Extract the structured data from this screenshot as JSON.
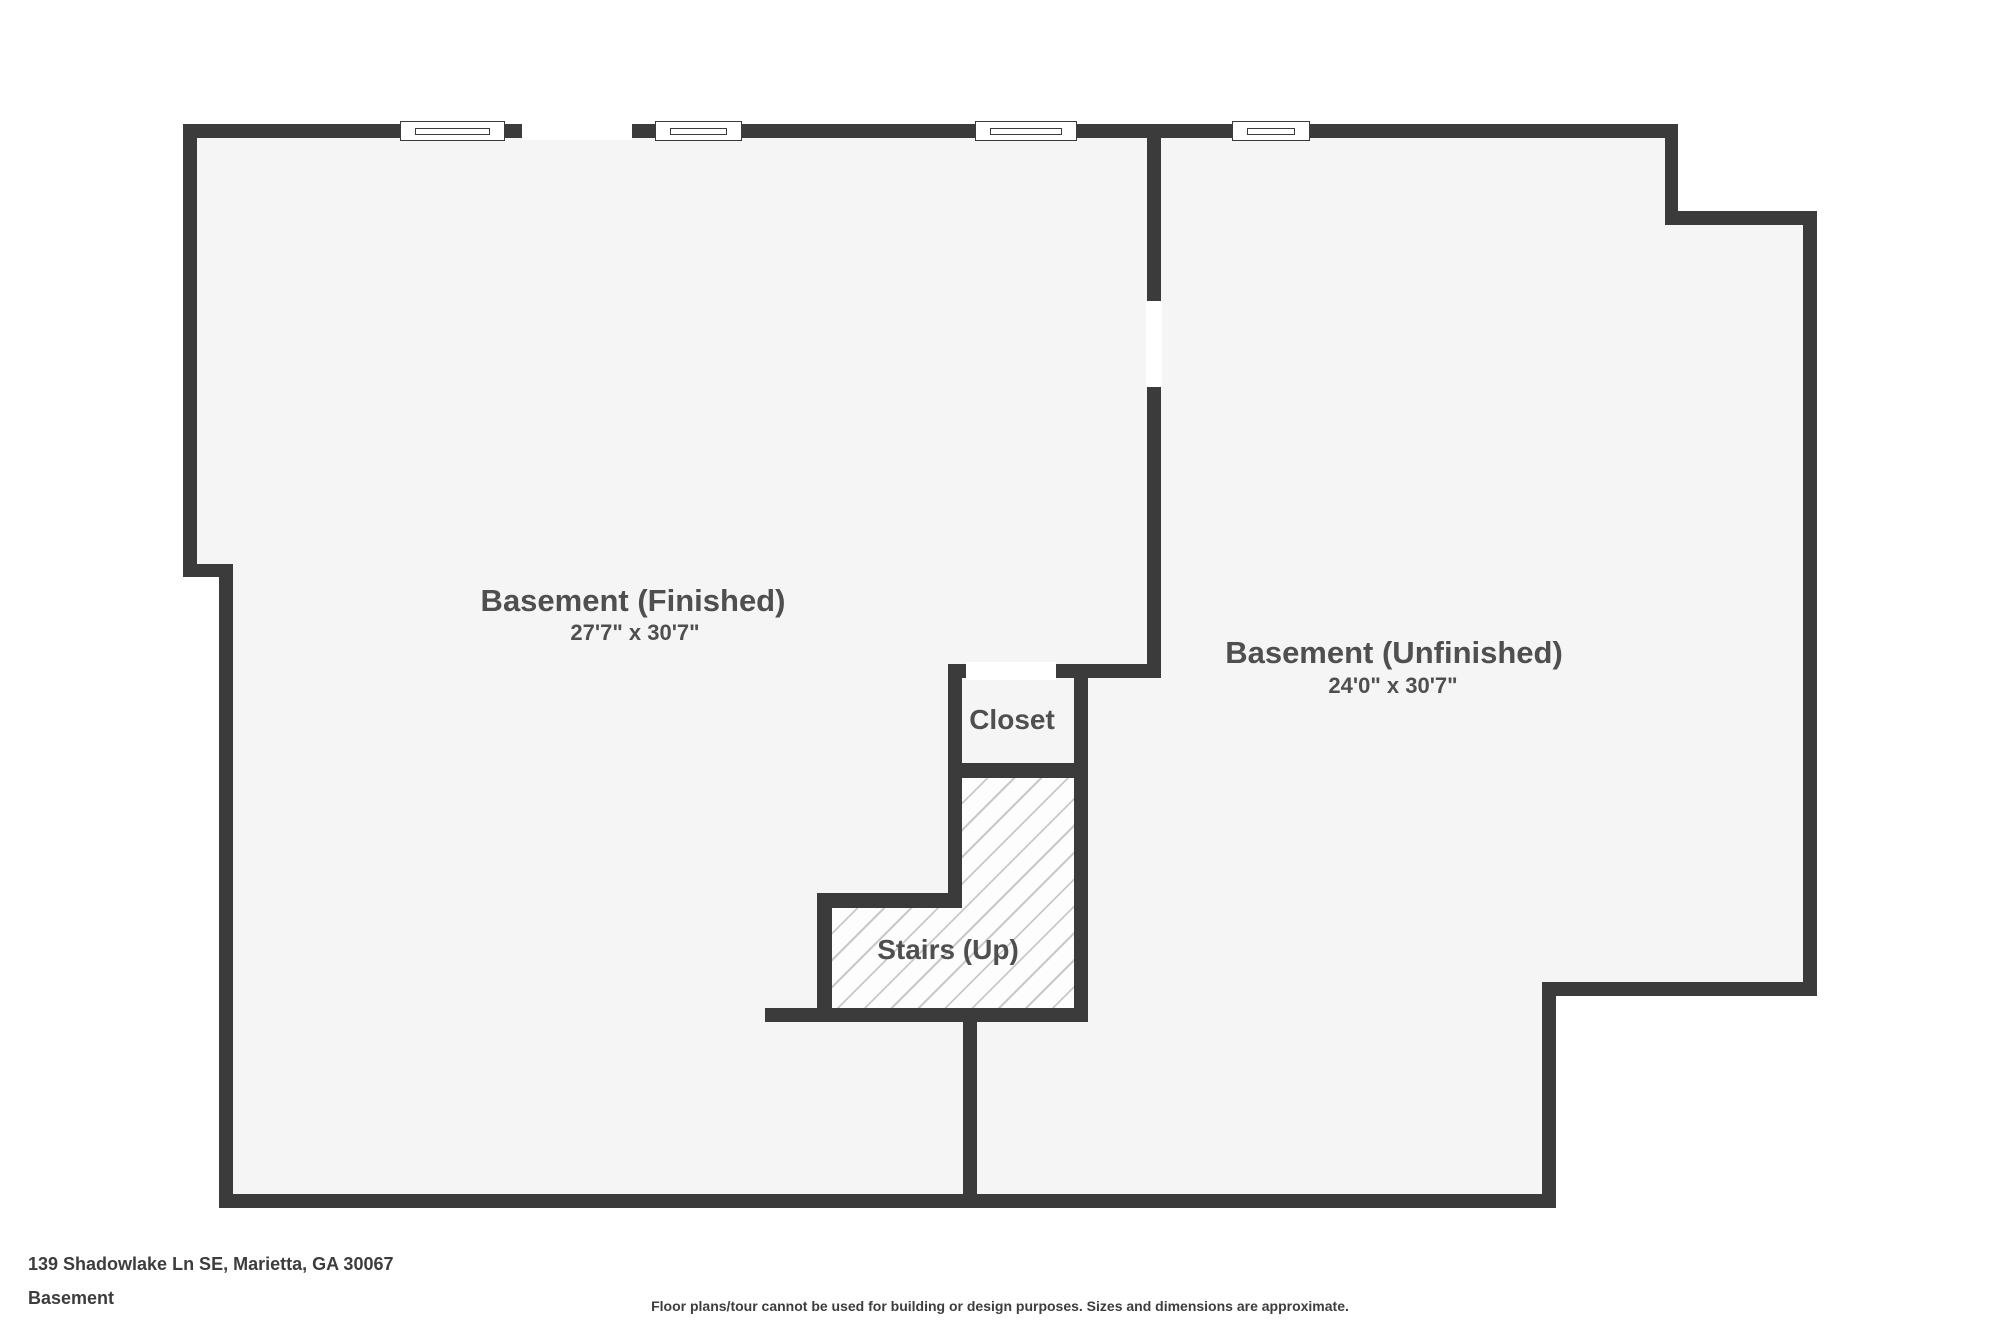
{
  "rooms": {
    "finished": {
      "name": "Basement (Finished)",
      "dims": "27'7\" x 30'7\""
    },
    "unfinished": {
      "name": "Basement (Unfinished)",
      "dims": "24'0\" x 30'7\""
    },
    "closet": {
      "name": "Closet"
    },
    "stairs": {
      "name": "Stairs (Up)"
    }
  },
  "footer": {
    "address": "139 Shadowlake Ln SE, Marietta, GA 30067",
    "level": "Basement",
    "disclaimer": "Floor plans/tour cannot be used for building or design purposes. Sizes and dimensions are approximate."
  },
  "colors": {
    "wall": "#3b3b3b",
    "floor": "#f5f5f5",
    "hatch_line": "#c9c9c9",
    "label_text": "#4f4f4f",
    "footer_text": "#3d3d3d",
    "background": "#ffffff"
  }
}
